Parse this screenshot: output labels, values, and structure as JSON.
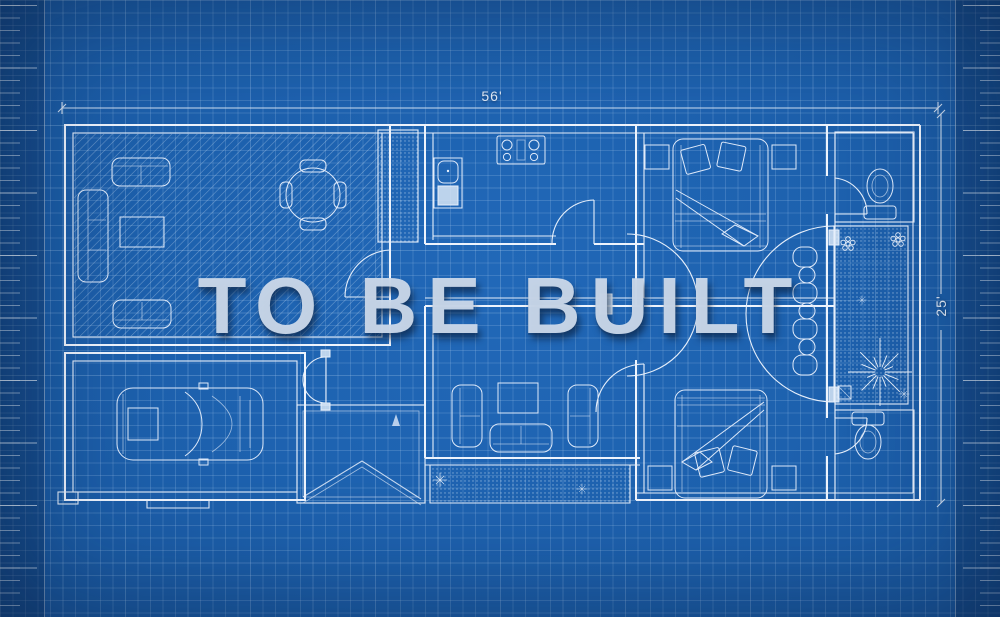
{
  "watermark": {
    "text": "TO BE BUILT"
  },
  "dimensions": {
    "width_label": "56'",
    "height_label": "25'"
  },
  "palette": {
    "background": "#1d61ae",
    "grid_line": "#a9c8e8",
    "drawing_line": "#e9f1fb",
    "watermark_fill": "#cad7e9",
    "watermark_shadow": "#0a2342"
  },
  "plan": {
    "type": "architectural-floor-plan",
    "style": "blueprint",
    "areas": [
      "living-room",
      "dining-area",
      "pantry",
      "kitchen",
      "bedroom-top",
      "bathroom-top",
      "patio",
      "breakfast-nook",
      "hallway",
      "family-room",
      "bedroom-bottom",
      "bathroom-bottom",
      "entry-vestibule",
      "porch",
      "garage"
    ],
    "furniture_symbols": [
      "sofa",
      "loveseat",
      "coffee-table",
      "round-dining-table",
      "dining-chair",
      "stove",
      "sink-refrigerator-unit",
      "double-bed",
      "pillow",
      "nightstand",
      "toilet",
      "sports-car",
      "lounge-chair",
      "side-table",
      "tree-starburst",
      "flower",
      "sparkle",
      "door-swing",
      "french-doors",
      "garage-door"
    ]
  }
}
